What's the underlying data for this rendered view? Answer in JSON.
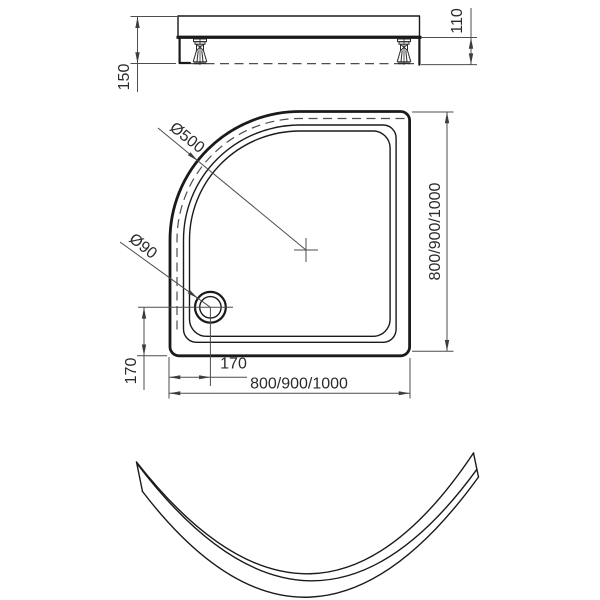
{
  "drawing": {
    "type": "shower-tray-technical-drawing",
    "colors": {
      "outline": "#1a1a1a",
      "dimension_lines": "#4d4d4d",
      "text": "#2b2b2b",
      "background": "#ffffff"
    },
    "side_view": {
      "total_height": "150",
      "underside_height": "110"
    },
    "plan_view": {
      "front_diameter": "Ø500",
      "drain_diameter": "Ø90",
      "drain_offset_x": "170",
      "drain_offset_y": "170",
      "width": "800/900/1000",
      "depth": "800/900/1000"
    }
  }
}
